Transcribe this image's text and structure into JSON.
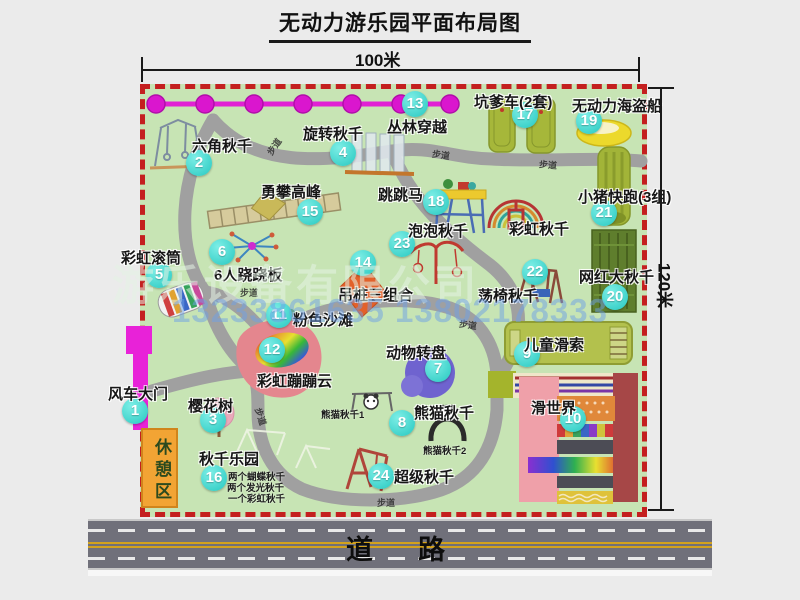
{
  "title": "无动力游乐园平面布局图",
  "dimensions": {
    "width_label": "100米",
    "height_label": "120米"
  },
  "road": {
    "label": "道　路"
  },
  "watermark": {
    "company": "游乐设备有限公司",
    "phone": "13233861635 13802178333"
  },
  "colors": {
    "park_green": "#c7e4b4",
    "border_red": "#c41f1f",
    "badge_teal": "#2fd5cd",
    "road_gray": "#70707a",
    "zipline_magenta": "#e120d4",
    "rest_area_orange": "#f2a434"
  },
  "map": {
    "walkway": {
      "label": "步道",
      "positions": [
        {
          "x": 265,
          "y": 140,
          "rot": -55
        },
        {
          "x": 432,
          "y": 148,
          "rot": 8
        },
        {
          "x": 539,
          "y": 158,
          "rot": 5
        },
        {
          "x": 240,
          "y": 286,
          "rot": 0
        },
        {
          "x": 459,
          "y": 318,
          "rot": 8
        },
        {
          "x": 252,
          "y": 410,
          "rot": 72
        },
        {
          "x": 377,
          "y": 496,
          "rot": 0
        }
      ]
    },
    "items": [
      {
        "num": 1,
        "label": "风车大门",
        "lx": 108,
        "ly": 383,
        "bx": 135,
        "by": 411
      },
      {
        "num": 2,
        "label": "六角秋千",
        "lx": 192,
        "ly": 135,
        "bx": 199,
        "by": 163
      },
      {
        "num": 3,
        "label": "樱花树",
        "lx": 188,
        "ly": 395,
        "bx": 213,
        "by": 420
      },
      {
        "num": 4,
        "label": "旋转秋千",
        "lx": 303,
        "ly": 123,
        "bx": 343,
        "by": 153
      },
      {
        "num": 5,
        "label": "彩虹滚筒",
        "lx": 121,
        "ly": 247,
        "bx": 159,
        "by": 275
      },
      {
        "num": 6,
        "label": "6人跷跷板",
        "lx": 214,
        "ly": 264,
        "bx": 222,
        "by": 252
      },
      {
        "num": 7,
        "label": "动物转盘",
        "lx": 386,
        "ly": 342,
        "bx": 438,
        "by": 369
      },
      {
        "num": 8,
        "label": "熊猫秋千",
        "lx": 414,
        "ly": 402,
        "bx": 402,
        "by": 423,
        "subs": [
          {
            "text": "熊猫秋千1",
            "x": 321,
            "y": 407
          },
          {
            "text": "熊猫秋千2",
            "x": 423,
            "y": 443
          }
        ]
      },
      {
        "num": 9,
        "label": "儿童滑索",
        "lx": 524,
        "ly": 334,
        "bx": 527,
        "by": 354
      },
      {
        "num": 10,
        "label": "滑世界",
        "lx": 531,
        "ly": 397,
        "bx": 573,
        "by": 419
      },
      {
        "num": 11,
        "label": "粉色沙滩",
        "lx": 293,
        "ly": 309,
        "bx": 279,
        "by": 315
      },
      {
        "num": 12,
        "label": "彩虹蹦蹦云",
        "lx": 257,
        "ly": 370,
        "bx": 272,
        "by": 350
      },
      {
        "num": 13,
        "label": "丛林穿越",
        "lx": 387,
        "ly": 116,
        "bx": 415,
        "by": 104
      },
      {
        "num": 14,
        "label": "吊桩三组合",
        "lx": 338,
        "ly": 284,
        "bx": 363,
        "by": 263
      },
      {
        "num": 15,
        "label": "勇攀高峰",
        "lx": 261,
        "ly": 181,
        "bx": 310,
        "by": 212
      },
      {
        "num": 16,
        "label": "秋千乐园",
        "lx": 199,
        "ly": 448,
        "bx": 214,
        "by": 478,
        "subs": [
          {
            "text": "两个蝴蝶秋千",
            "x": 228,
            "y": 469
          },
          {
            "text": "两个发光秋千",
            "x": 227,
            "y": 480
          },
          {
            "text": "一个彩虹秋千",
            "x": 228,
            "y": 491
          }
        ]
      },
      {
        "num": 17,
        "label": "坑爹车(2套)",
        "lx": 474,
        "ly": 91,
        "bx": 525,
        "by": 115
      },
      {
        "num": 18,
        "label": "跳跳马",
        "lx": 378,
        "ly": 184,
        "bx": 436,
        "by": 202
      },
      {
        "num": 19,
        "label": "无动力海盗船",
        "lx": 572,
        "ly": 95,
        "bx": 589,
        "by": 121
      },
      {
        "num": 20,
        "label": "网红大秋千",
        "lx": 579,
        "ly": 266,
        "bx": 615,
        "by": 297
      },
      {
        "num": 21,
        "label": "小猪快跑(3组)",
        "lx": 578,
        "ly": 186,
        "bx": 604,
        "by": 213
      },
      {
        "num": 22,
        "label": "荡椅秋千",
        "lx": 478,
        "ly": 285,
        "bx": 535,
        "by": 272
      },
      {
        "num": 23,
        "label": "泡泡秋千",
        "lx": 408,
        "ly": 220,
        "bx": 402,
        "by": 244
      },
      {
        "num": 24,
        "label": "超级秋千",
        "lx": 394,
        "ly": 466,
        "bx": 381,
        "by": 476
      },
      {
        "slug": "rainbow-swing",
        "label": "彩虹秋千",
        "lx": 509,
        "ly": 218
      },
      {
        "slug": "rest-area",
        "label": "休憩区",
        "lx": 149,
        "ly": 438,
        "vertical": true
      }
    ]
  }
}
